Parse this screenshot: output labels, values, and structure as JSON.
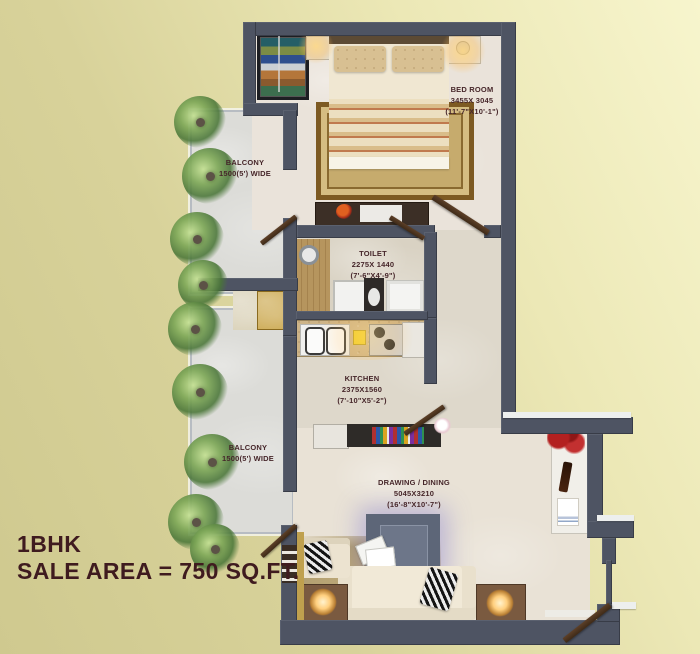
{
  "plan": {
    "title_line1": "1BHK",
    "title_line2": "SALE AREA = 750 SQ.FT.",
    "rooms": {
      "bedroom": {
        "name": "BED ROOM",
        "size_mm": "3455X 3045",
        "size_ft": "(11'-7\"X10'-1\")"
      },
      "balcony_top": {
        "name": "BALCONY",
        "size": "1500(5') WIDE"
      },
      "toilet": {
        "name": "TOILET",
        "size_mm": "2275X 1440",
        "size_ft": "(7'-6\"X4'-9\")"
      },
      "kitchen": {
        "name": "KITCHEN",
        "size_mm": "2375X1560",
        "size_ft": "(7'-10\"X5'-2\")"
      },
      "drawing_dining": {
        "name": "DRAWING / DINING",
        "size_mm": "5045X3210",
        "size_ft": "(16'-8\"X10'-7\")"
      },
      "balcony_bottom": {
        "name": "BALCONY",
        "size": "1500(5') WIDE"
      }
    },
    "colors": {
      "background_left": "#d5cf96",
      "background_topright": "#f6f4cc",
      "wall": "#4e5463",
      "label_text": "#46262a",
      "title_text": "#3f1b1f"
    }
  }
}
